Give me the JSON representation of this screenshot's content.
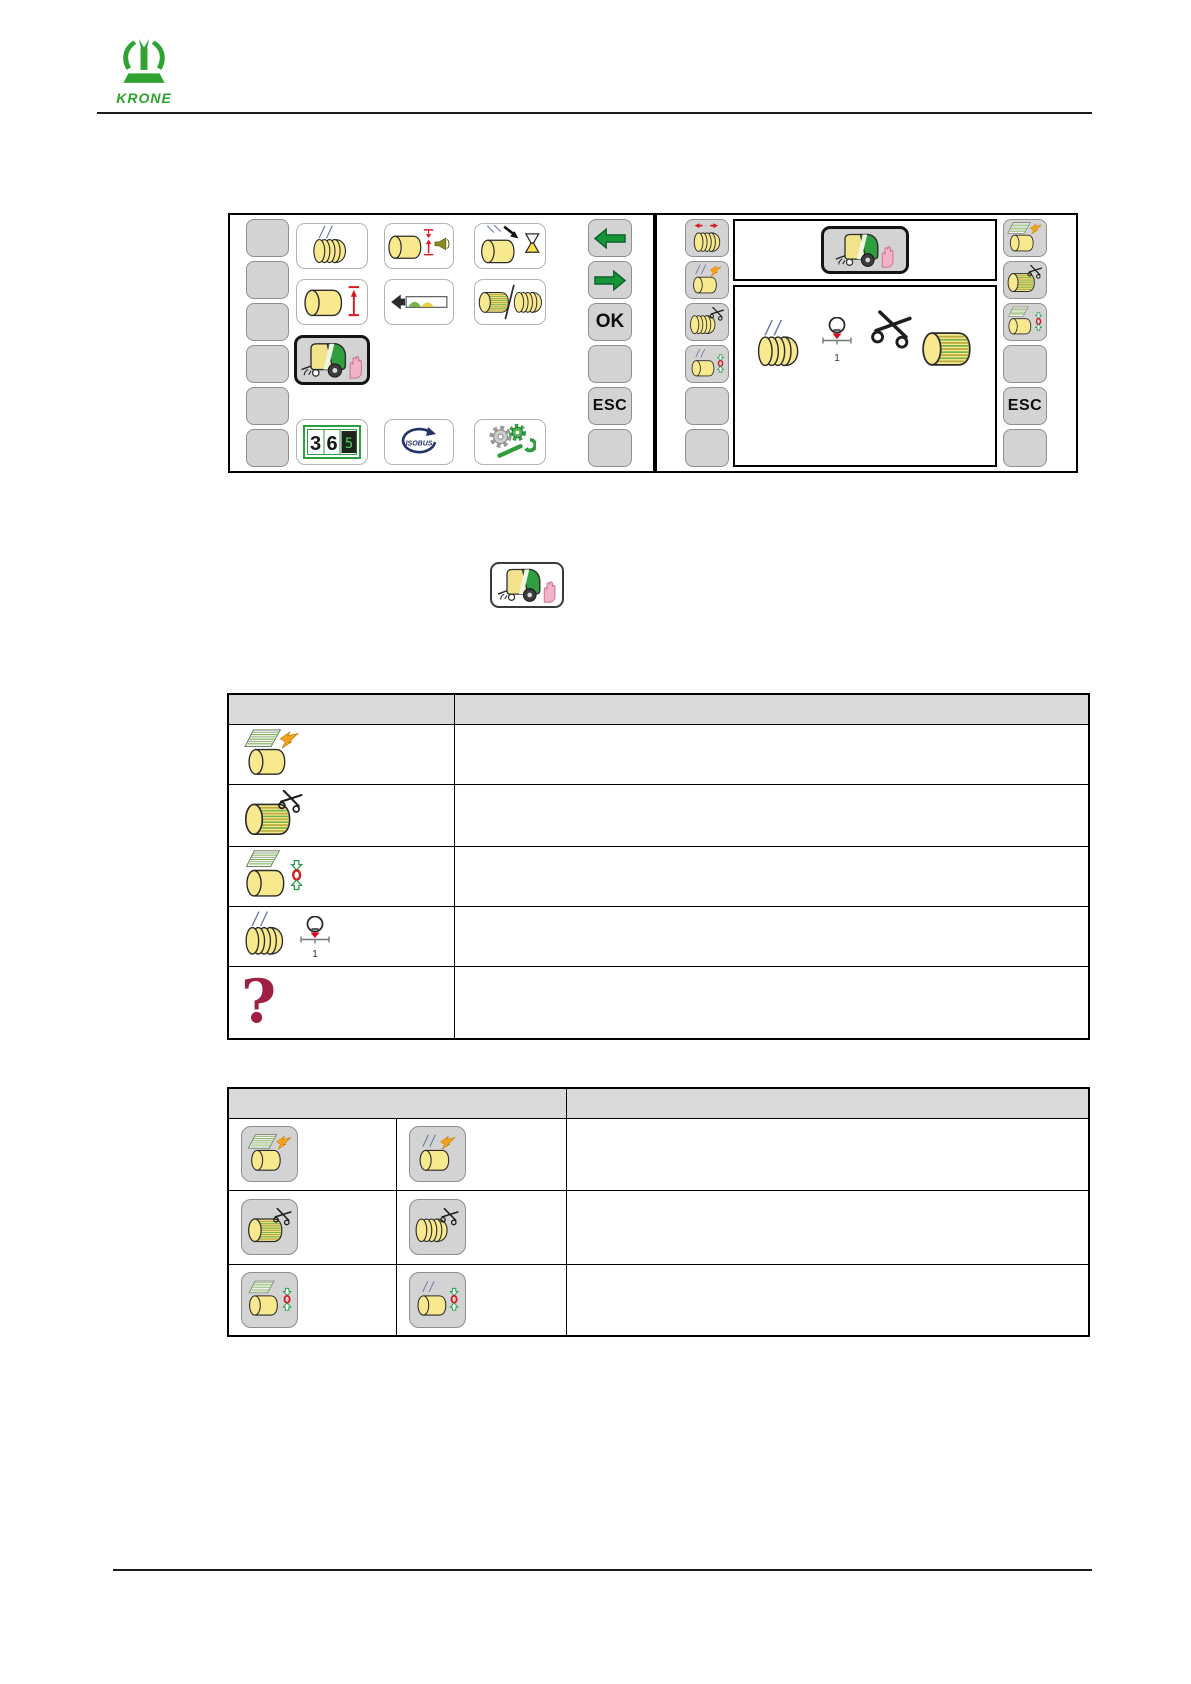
{
  "brand": {
    "name": "KRONE"
  },
  "colors": {
    "krone_green": "#2fa32f",
    "softkey_gray": "#d3d3d3",
    "bale_yellow": "#f9e98e",
    "net_green": "#79b24c",
    "signal_red": "#d71920",
    "lightning_orange": "#f5a31f",
    "isobus_navy": "#25336b",
    "question_dark_red": "#9e2043",
    "table_header_gray": "#dadada",
    "nav_arrow_green": "#149639"
  },
  "left_screen": {
    "nav_ok": "OK",
    "nav_esc": "ESC",
    "counter": {
      "d1": "3",
      "d2": "6",
      "d3": "5"
    },
    "isobus_label": "ISOBUS",
    "menu_icons": [
      "twine-bale-icon",
      "bale-diameter-signal-horn-icon",
      "bale-tying-delay-hourglass-icon",
      "bale-diameter-setting-icon",
      "fill-direction-indicator-icon",
      "net-twine-selection-icon",
      "manual-mode-baler-hand-icon",
      "bale-counter-icon",
      "isobus-icon",
      "settings-gears-wrench-icon"
    ],
    "selected_icon": "manual-mode-baler-hand-icon"
  },
  "right_screen": {
    "esc": "ESC",
    "slip_scale_value": "1",
    "left_softkey_icons": [
      "twine-move-arrows-icon",
      "twine-feed-lightning-icon",
      "twine-cut-scissors-icon",
      "twine-zero-position-icon",
      "",
      ""
    ],
    "right_softkey_icons": [
      "net-feed-lightning-icon",
      "net-cut-scissors-icon",
      "net-zero-position-icon",
      "",
      "ESC",
      ""
    ],
    "header_icon": "manual-mode-baler-hand-icon"
  },
  "inline_icon": "manual-mode-baler-hand-icon",
  "table1": {
    "rows": [
      {
        "icon": "net-feed-lightning-icon",
        "description": ""
      },
      {
        "icon": "net-cut-scissors-icon",
        "description": ""
      },
      {
        "icon": "net-zero-position-icon",
        "description": ""
      },
      {
        "icon": "twine-slip-indicator-icon",
        "scale_value": "1",
        "description": ""
      },
      {
        "icon": "question-mark-icon",
        "glyph": "?",
        "description": ""
      }
    ]
  },
  "table2": {
    "rows": [
      {
        "icon_left": "net-feed-softkey-icon",
        "icon_right": "twine-feed-softkey-icon",
        "description": ""
      },
      {
        "icon_left": "net-cut-softkey-icon",
        "icon_right": "twine-cut-softkey-icon",
        "description": ""
      },
      {
        "icon_left": "net-zero-softkey-icon",
        "icon_right": "twine-zero-softkey-icon",
        "description": ""
      }
    ]
  }
}
